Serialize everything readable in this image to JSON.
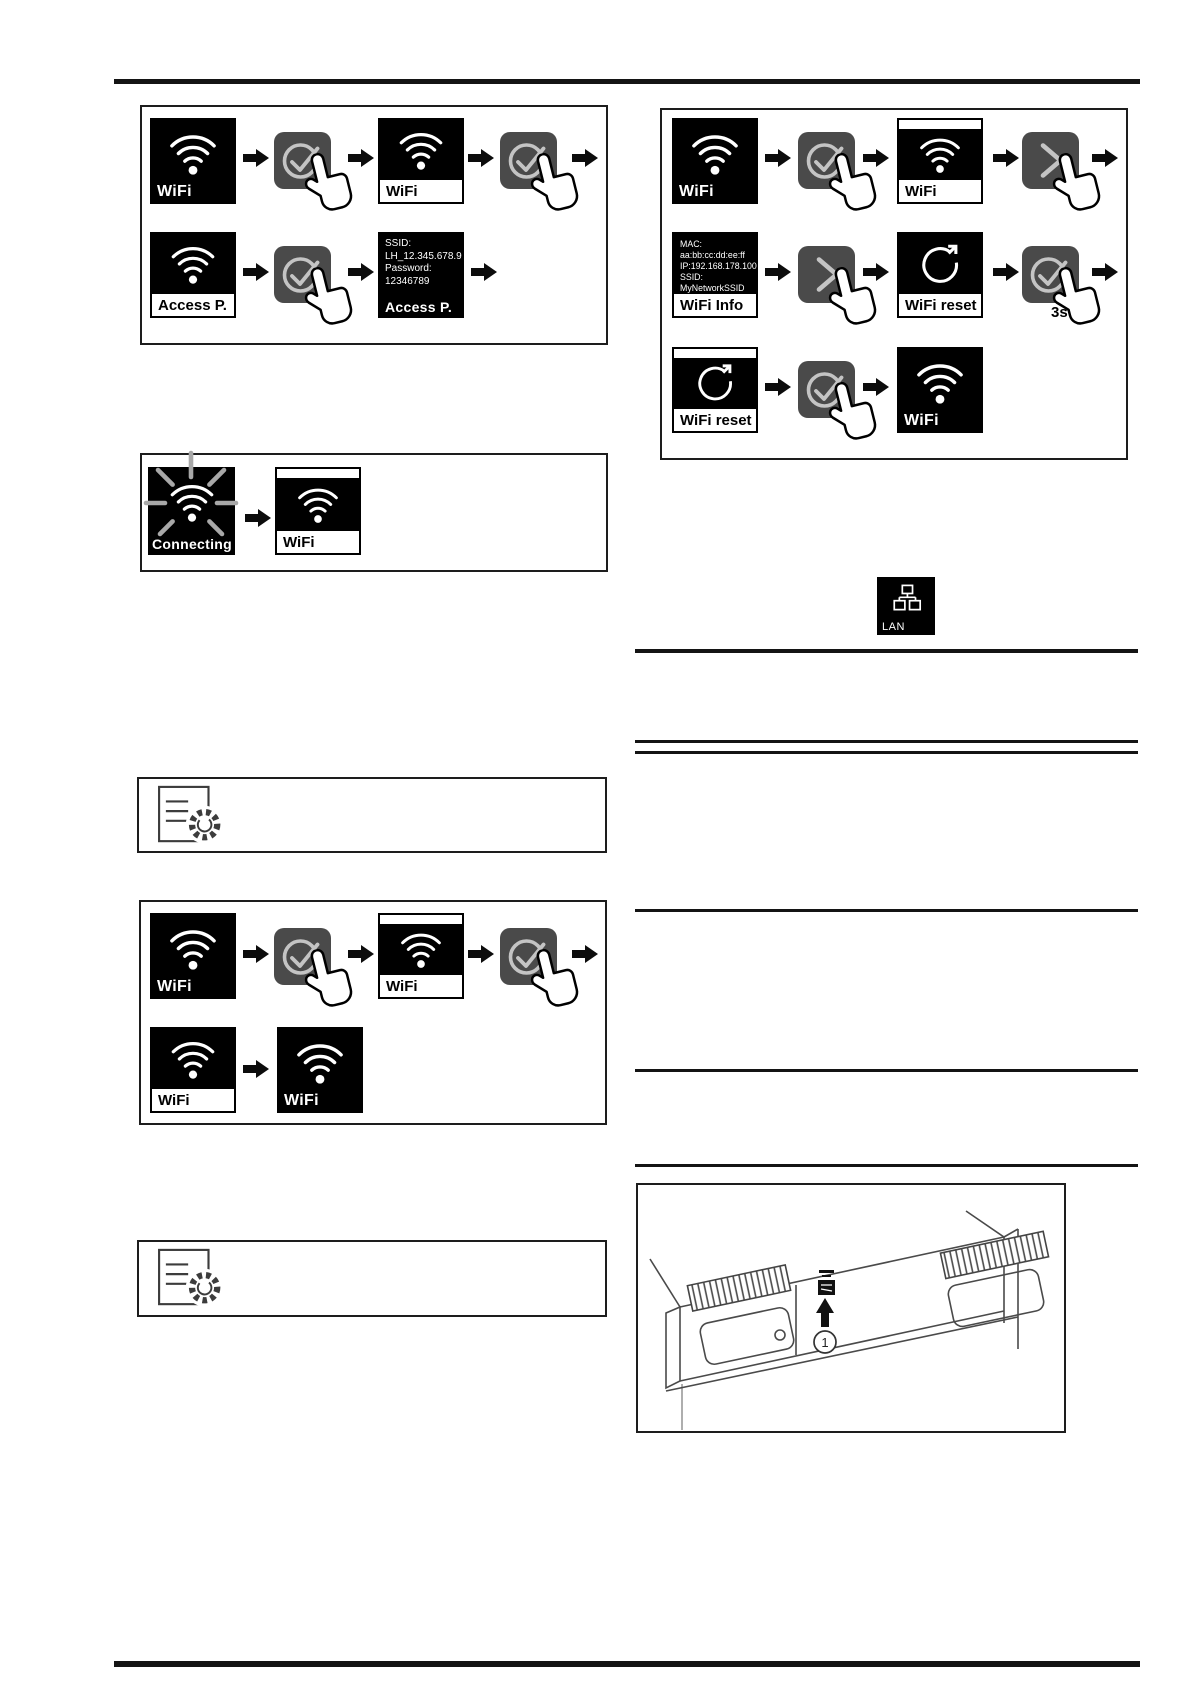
{
  "device_display": {
    "wifi_label": "WiFi",
    "access_point_label": "Access P.",
    "connecting_label": "Connecting",
    "wifi_info_label": "WiFi Info",
    "wifi_reset_label": "WiFi reset",
    "lan_label": "LAN"
  },
  "access_point_screen": {
    "ssid_caption": "SSID:",
    "ssid_value": "LH_12.345.678.9",
    "password_caption": "Password:",
    "password_value": "12346789",
    "title": "Access P."
  },
  "wifi_info_screen": {
    "mac_line": "MAC: aa:bb:cc:dd:ee:ff",
    "ip_line": "IP:192.168.178.100",
    "ssid_line": "SSID: MyNetworkSSID",
    "signal_line": "Signal: hoch",
    "title": "WiFi Info"
  },
  "annotations": {
    "hold_duration": "3s",
    "callout_number": "1"
  },
  "colors": {
    "display_background": "#000000",
    "display_foreground": "#ffffff",
    "button_background": "#4a4a4a",
    "button_glyph": "#c4c4c4",
    "connecting_rays": "#a8a8a8",
    "rule_color": "#141414"
  }
}
